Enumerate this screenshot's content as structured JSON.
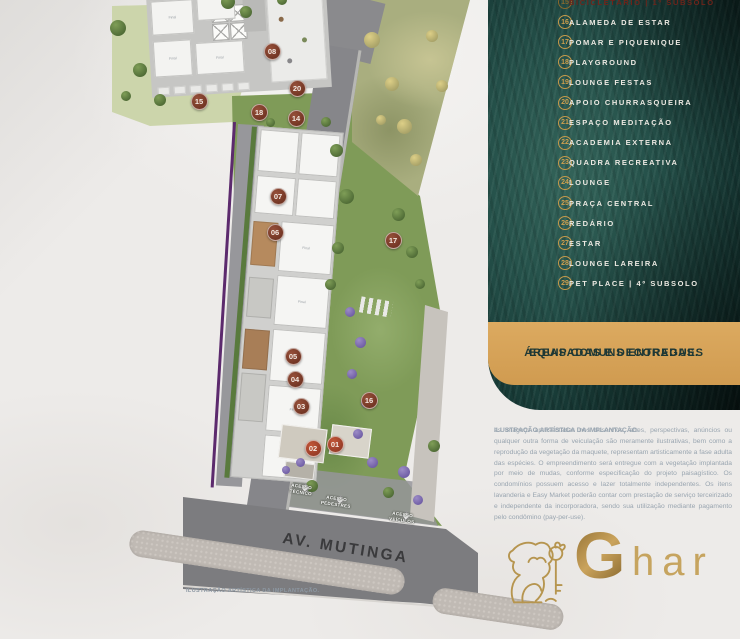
{
  "legend": {
    "circle_color": "#c59a4b",
    "text_color": "#ece9e2",
    "highlight_color": "#6e241a",
    "items": [
      {
        "num": "15",
        "label": "BICICLETÁRIO | 1º SUBSOLO",
        "highlight": true
      },
      {
        "num": "16",
        "label": "ALAMEDA DE ESTAR"
      },
      {
        "num": "17",
        "label": "POMAR E PIQUENIQUE"
      },
      {
        "num": "18",
        "label": "PLAYGROUND"
      },
      {
        "num": "19",
        "label": "LOUNGE FESTAS"
      },
      {
        "num": "20",
        "label": "APOIO CHURRASQUEIRA"
      },
      {
        "num": "21",
        "label": "ESPAÇO MEDITAÇÃO"
      },
      {
        "num": "22",
        "label": "ACADEMIA EXTERNA"
      },
      {
        "num": "23",
        "label": "QUADRA RECREATIVA"
      },
      {
        "num": "24",
        "label": "LOUNGE"
      },
      {
        "num": "25",
        "label": "PRAÇA CENTRAL"
      },
      {
        "num": "26",
        "label": "REDÁRIO"
      },
      {
        "num": "27",
        "label": "ESTAR"
      },
      {
        "num": "28",
        "label": "LOUNGE LAREIRA"
      },
      {
        "num": "29",
        "label": "PET PLACE | 4º SUBSOLO"
      }
    ]
  },
  "banner": {
    "line1": "ÁREAS COMUNS ENTREGUES",
    "line2": "EQUIPADAS E DECORADAS.",
    "bg": "#d7a259",
    "text_color": "#1e3835"
  },
  "disclaimer": {
    "title": "ILUSTRAÇÃO ARTÍSTICA DA IMPLANTAÇÃO:",
    "body": " as imagens apresentadas nos desenhos, artes, perspectivas, anúncios ou qualquer outra forma de veiculação são meramente ilustrativas, bem como a reprodução da vegetação da maquete, representam artisticamente a fase adulta das espécies. O empreendimento será entregue com a vegetação implantada por meio de mudas, conforme especificação do projeto paisagístico. Os condomínios possuem acesso e lazer totalmente independentes. Os itens lavanderia e Easy Market poderão contar com prestação de serviço terceirizado e independente da incorporadora, sendo sua utilização mediante pagamento pelo condômino (pay-per-use)."
  },
  "logo": {
    "brand_g": "G",
    "brand_rest": "har",
    "gold": "#b6954f",
    "lion_icon": "lion-with-key-icon"
  },
  "plan": {
    "street_label": "AV. MUTINGA",
    "caption": "ILUSTRAÇÃO ARTÍSTICA DA IMPLANTAÇÃO.",
    "unit_label": "Final",
    "marker_color": "#7c3a28",
    "access_points": [
      {
        "label": "ACESSO TÉCNICO",
        "x": 302,
        "y": 484
      },
      {
        "label": "ACESSO PEDESTRES",
        "x": 337,
        "y": 496
      },
      {
        "label": "ACESSO VEÍCULOS",
        "x": 403,
        "y": 512
      }
    ],
    "markers": [
      {
        "num": "01",
        "x": 335,
        "y": 444,
        "bright": true
      },
      {
        "num": "02",
        "x": 313,
        "y": 448,
        "bright": true
      },
      {
        "num": "03",
        "x": 301,
        "y": 406
      },
      {
        "num": "04",
        "x": 295,
        "y": 379
      },
      {
        "num": "05",
        "x": 293,
        "y": 356
      },
      {
        "num": "06",
        "x": 275,
        "y": 232
      },
      {
        "num": "07",
        "x": 278,
        "y": 196
      },
      {
        "num": "08",
        "x": 272,
        "y": 51
      },
      {
        "num": "14",
        "x": 296,
        "y": 118
      },
      {
        "num": "15",
        "x": 199,
        "y": 101
      },
      {
        "num": "16",
        "x": 369,
        "y": 400
      },
      {
        "num": "17",
        "x": 393,
        "y": 240
      },
      {
        "num": "18",
        "x": 259,
        "y": 112
      },
      {
        "num": "20",
        "x": 297,
        "y": 88
      }
    ]
  }
}
